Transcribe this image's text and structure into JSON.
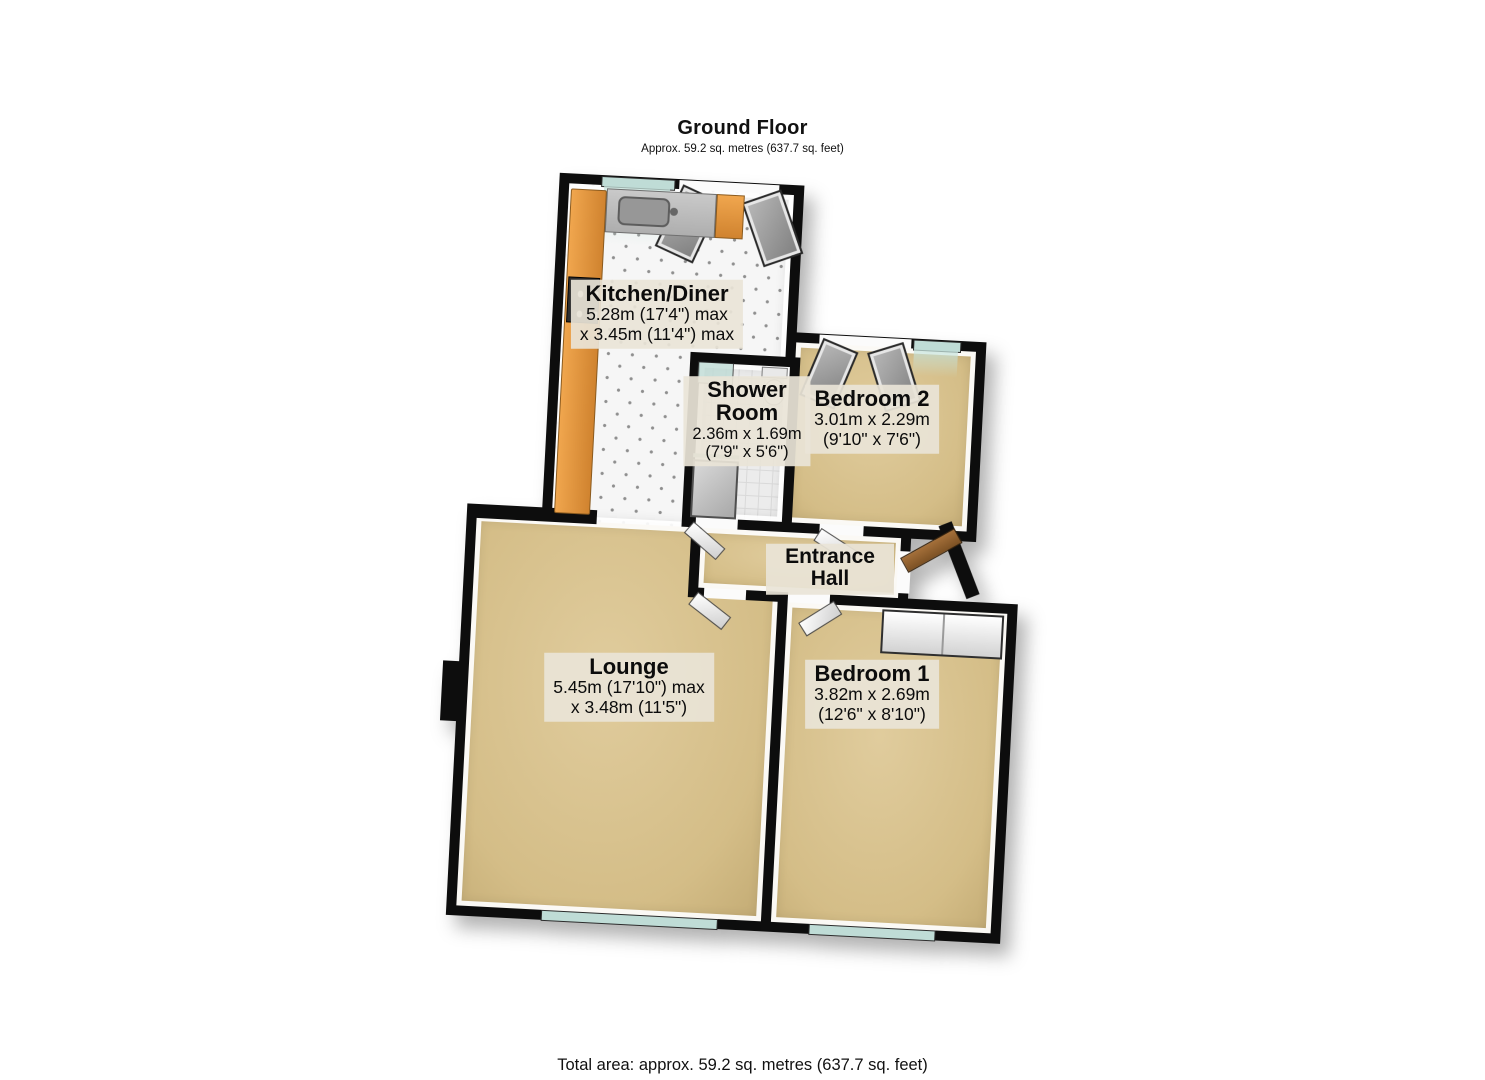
{
  "header": {
    "title": "Ground Floor",
    "subtitle": "Approx. 59.2 sq. metres (637.7 sq. feet)"
  },
  "footer": {
    "total_area": "Total area: approx. 59.2 sq. metres (637.7 sq. feet)"
  },
  "rooms": {
    "kitchen": {
      "name": "Kitchen/Diner",
      "dim1": "5.28m (17'4\") max",
      "dim2": "x 3.45m (11'4\") max"
    },
    "shower": {
      "name": "Shower Room",
      "dim1": "2.36m x 1.69m",
      "dim2": "(7'9\" x 5'6\")"
    },
    "bedroom2": {
      "name": "Bedroom 2",
      "dim1": "3.01m x 2.29m",
      "dim2": "(9'10\" x 7'6\")"
    },
    "hall": {
      "name": "Entrance Hall"
    },
    "lounge": {
      "name": "Lounge",
      "dim1": "5.45m (17'10\") max",
      "dim2": "x 3.48m (11'5\")"
    },
    "bedroom1": {
      "name": "Bedroom 1",
      "dim1": "3.82m x 2.69m",
      "dim2": "(12'6\" x 8'10\")"
    }
  },
  "colors": {
    "wall": "#0d0d0d",
    "carpet": "#d4bd87",
    "carpet_light": "#e0cc9d",
    "tile_dot": "#8f8f8f",
    "window": "#bfdcd6",
    "counter": "#f0a64e",
    "front_door": "#a5703a",
    "label_bg": "#e9e4d7"
  }
}
